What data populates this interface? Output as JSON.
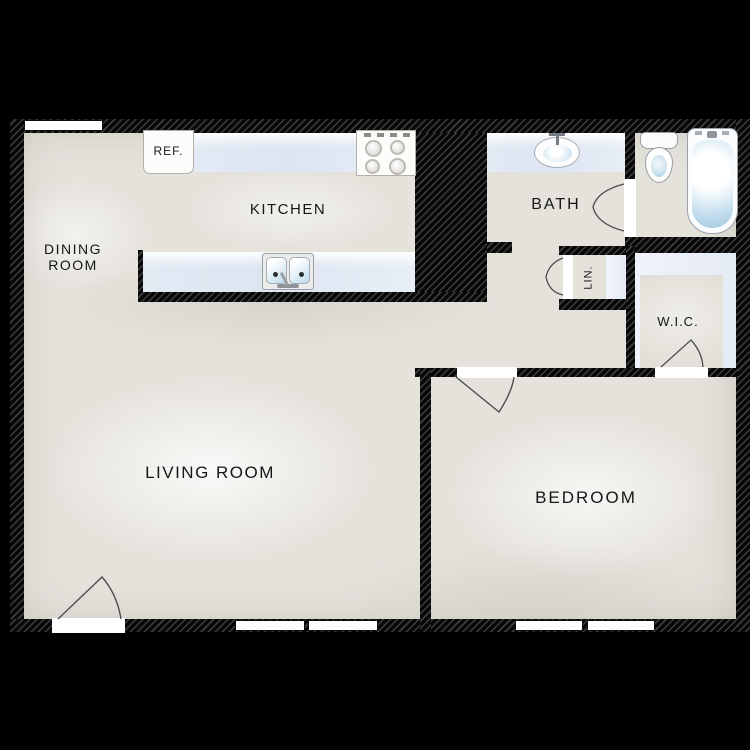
{
  "plan": {
    "type": "apartment-floor-plan",
    "rooms": {
      "dining": {
        "line1": "DINING",
        "line2": "ROOM"
      },
      "kitchen": {
        "label": "KITCHEN"
      },
      "bath": {
        "label": "BATH"
      },
      "linen": {
        "label": "LIN."
      },
      "wic": {
        "label": "W.I.C."
      },
      "living": {
        "label": "LIVING ROOM"
      },
      "bedroom": {
        "label": "BEDROOM"
      }
    },
    "fixtures": {
      "refrigerator": {
        "label": "REF."
      },
      "stove": "stove-4-burner",
      "kitchen_sink": "double-basin-sink",
      "bath_sink": "oval-vanity-sink",
      "toilet": "toilet",
      "bathtub": "bathtub"
    },
    "colors": {
      "background": "#000000",
      "wall": "#070707",
      "wall_hatch": "#3e3e3e",
      "floor": "#e5e2dc",
      "counter": "#e3eaf4",
      "fixture_water": "#bedbec",
      "window": "#ffffff",
      "label_text": "#161616"
    }
  }
}
